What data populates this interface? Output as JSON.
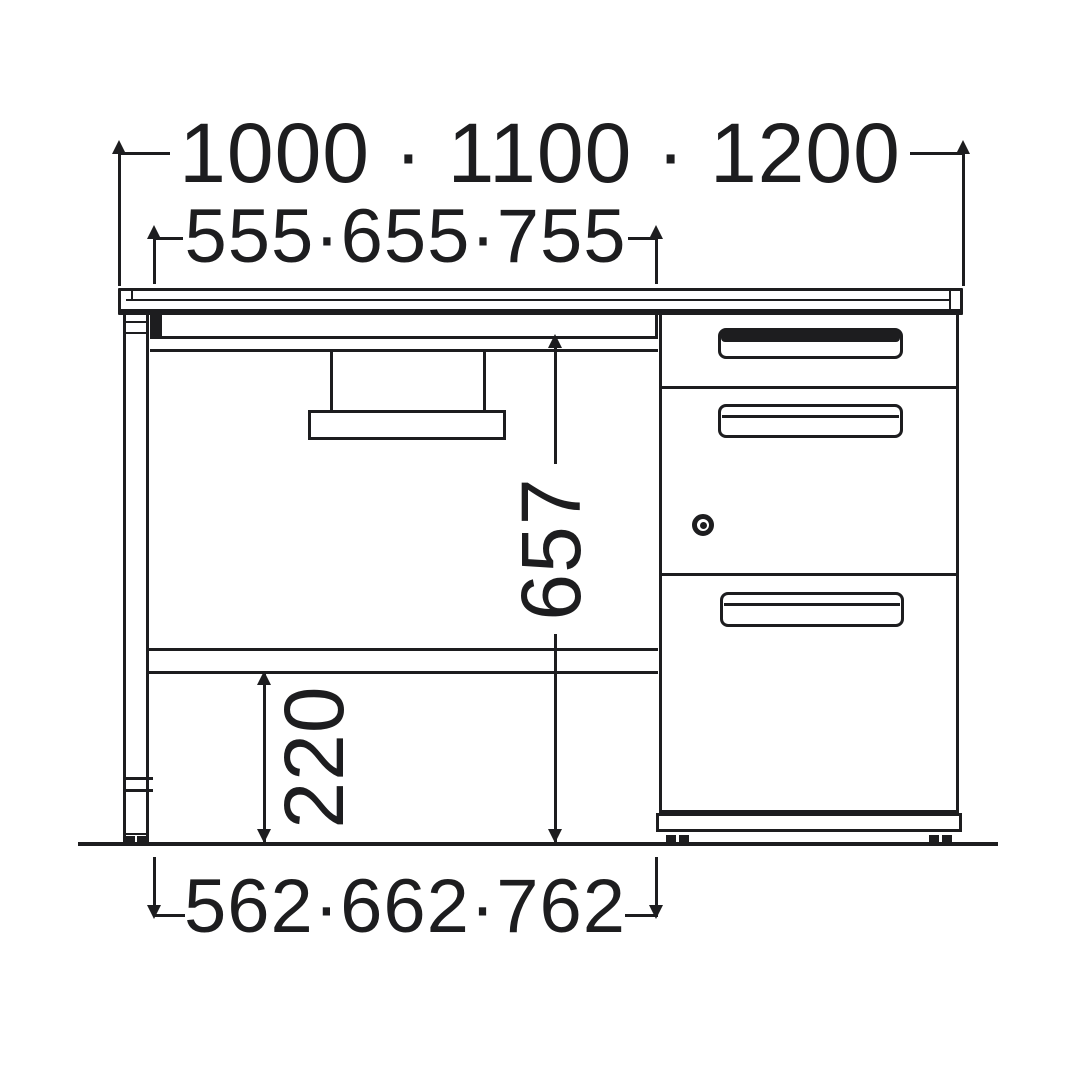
{
  "diagram": {
    "type": "desk-dimension-drawing",
    "dimensions": {
      "overall_width": "1000 · 1100 · 1200",
      "top_clear_width": "555·655·755",
      "under_top_height": "657",
      "base_clearance_height": "220",
      "knee_space_width": "562·662·762"
    },
    "colors": {
      "stroke": "#1d1d1f",
      "background": "#ffffff"
    }
  }
}
